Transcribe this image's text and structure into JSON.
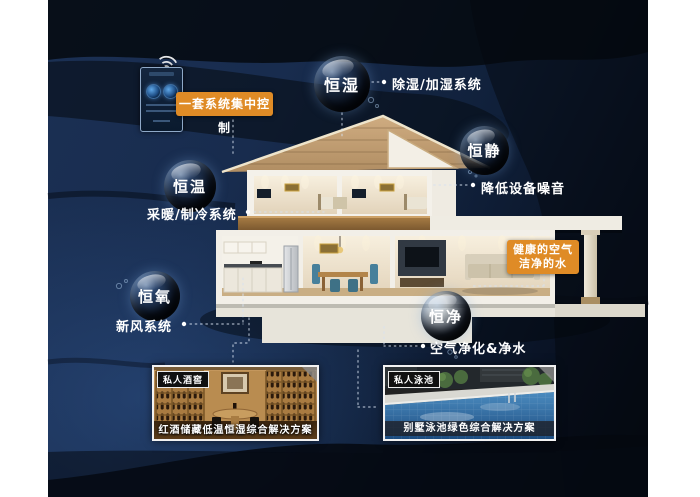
{
  "control_panel": {
    "label": "一套系统集中控制",
    "icon": "wifi-icon"
  },
  "features": [
    {
      "bubble": "恒湿",
      "description": "除湿/加湿系统"
    },
    {
      "bubble": "恒静",
      "description": "降低设备噪音"
    },
    {
      "bubble": "恒温",
      "description": "采暖/制冷系统"
    },
    {
      "bubble": "恒氧",
      "description": "新风系统"
    },
    {
      "bubble": "恒净",
      "description": "空气净化&净水"
    }
  ],
  "highlight": {
    "line1": "健康的空气",
    "line2": "洁净的水"
  },
  "cases": [
    {
      "tag": "私人酒窖",
      "caption": "红酒储藏低温恒湿综合解决方案"
    },
    {
      "tag": "私人泳池",
      "caption": "别墅泳池绿色综合解决方案"
    }
  ],
  "colors": {
    "accent": "#DF8B26",
    "canvas": "#1B3054",
    "text": "#FFFFFF"
  }
}
